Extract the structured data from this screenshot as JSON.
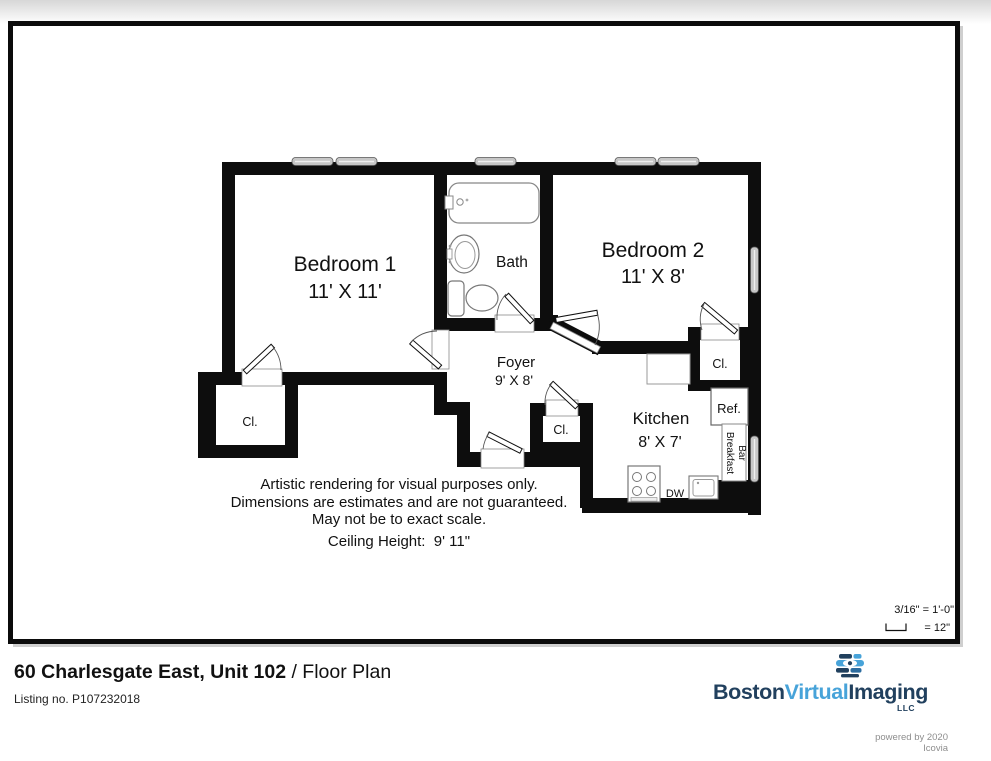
{
  "floor_plan": {
    "rooms": {
      "bedroom1": {
        "name": "Bedroom 1",
        "dims": "11' X 11'"
      },
      "bedroom2": {
        "name": "Bedroom 2",
        "dims": "11' X 8'"
      },
      "bath": {
        "name": "Bath"
      },
      "foyer": {
        "name": "Foyer",
        "dims": "9' X 8'"
      },
      "kitchen": {
        "name": "Kitchen",
        "dims": "8' X 7'"
      }
    },
    "labels": {
      "closet": "Cl.",
      "refrigerator": "Ref.",
      "dishwasher": "DW",
      "breakfast_bar_line1": "Breakfast",
      "breakfast_bar_line2": "Bar"
    },
    "disclaimer": {
      "line1": "Artistic rendering for visual purposes only.",
      "line2": "Dimensions are estimates and are not guaranteed.",
      "line3": "May not be to exact scale.",
      "ceiling_height": "Ceiling Height:  9' 11\""
    },
    "scale_note": {
      "line1": "3/16\" = 1'-0\"",
      "line2": "= 12\""
    }
  },
  "footer": {
    "title_main": "60 Charlesgate East, Unit 102",
    "title_suffix": " / Floor Plan",
    "listing": "Listing no. P107232018"
  },
  "branding": {
    "word1": "Boston",
    "word2": "Virtual",
    "word3": "Imaging",
    "llc": "LLC",
    "powered_by": "powered by 2020 Icovia",
    "navy": "#21405e",
    "light_blue": "#47a3d9",
    "powered_gray": "#8e8e8e"
  }
}
